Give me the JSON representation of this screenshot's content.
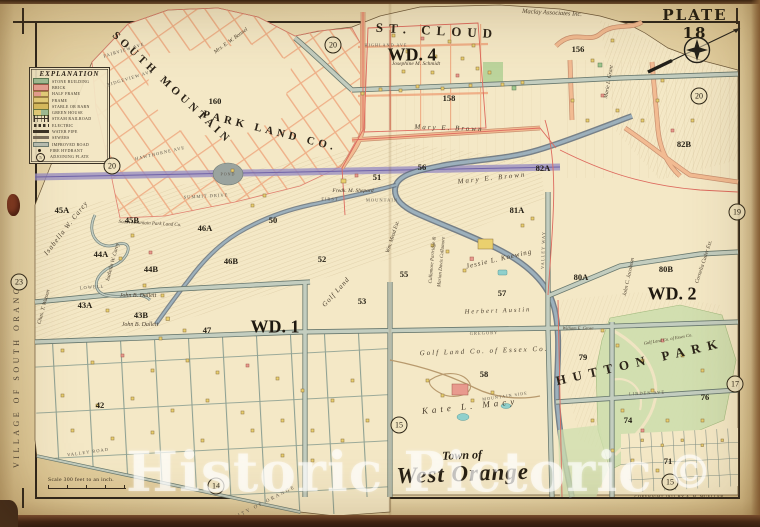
{
  "plate": {
    "label": "PLATE 18"
  },
  "title": {
    "prefix": "Town of",
    "name": "West Orange"
  },
  "village_edge": "VILLAGE OF SOUTH ORANGE",
  "scale": {
    "text": "Scale 300 feet to an inch."
  },
  "copyright": {
    "text": "COPYRIGHT 1911 BY A. H. MUELLER."
  },
  "watermark": {
    "text": "Historic Pictoric",
    "mark": "©"
  },
  "legend": {
    "title": "EXPLANATION",
    "items": [
      {
        "label": "STONE BUILDING",
        "swatch": "stone"
      },
      {
        "label": "BRICK",
        "swatch": "brick"
      },
      {
        "label": "HALF FRAME",
        "swatch": "half"
      },
      {
        "label": "FRAME",
        "swatch": "frame"
      },
      {
        "label": "STABLE OR BARN",
        "swatch": "stable"
      },
      {
        "label": "GREEN HOUSE",
        "swatch": "ghouse"
      },
      {
        "label": "STEAM RAILROAD",
        "swatch": "rail"
      },
      {
        "label": "ELECTRIC",
        "swatch": "elec"
      },
      {
        "label": "WATER PIPE",
        "swatch": "water"
      },
      {
        "label": "SEWERS",
        "swatch": "sewer"
      },
      {
        "label": "IMPROVED ROAD",
        "swatch": "road"
      },
      {
        "label": "FIRE HYDRANT",
        "swatch": "hyd"
      },
      {
        "label": "ADJOINING PLATE",
        "swatch": "plate",
        "mark": "5"
      }
    ]
  },
  "map_labels": [
    {
      "t": "ST. CLOUD",
      "x": 437,
      "y": 31,
      "r": 3,
      "s": 13,
      "ls": 6,
      "c": "region"
    },
    {
      "t": "WD. 4",
      "x": 412,
      "y": 55,
      "r": 0,
      "s": 18,
      "ls": 0,
      "c": "ward"
    },
    {
      "t": "WD. 1",
      "x": 275,
      "y": 327,
      "r": 0,
      "s": 18,
      "ls": 0,
      "c": "ward"
    },
    {
      "t": "WD. 2",
      "x": 672,
      "y": 294,
      "r": 0,
      "s": 18,
      "ls": 0,
      "c": "ward"
    },
    {
      "t": "SOUTH MOUNTAIN",
      "x": 172,
      "y": 88,
      "r": 43,
      "s": 11,
      "ls": 4,
      "c": "region"
    },
    {
      "t": "PARK LAND CO.",
      "x": 270,
      "y": 131,
      "r": 14,
      "s": 11,
      "ls": 4,
      "c": "region"
    },
    {
      "t": "HUTTON PARK",
      "x": 640,
      "y": 362,
      "r": -13,
      "s": 13,
      "ls": 7,
      "c": "region"
    },
    {
      "t": "CITY OF ORANGE",
      "x": 265,
      "y": 503,
      "r": -27,
      "s": 5,
      "ls": 2,
      "c": "street"
    },
    {
      "t": "POND",
      "x": 228,
      "y": 174,
      "r": 0,
      "s": 4,
      "ls": 1,
      "c": "street"
    },
    {
      "t": "FIRST",
      "x": 330,
      "y": 199,
      "r": 0,
      "s": 4.5,
      "ls": 1,
      "c": "street"
    },
    {
      "t": "MOUNTAIN",
      "x": 382,
      "y": 200,
      "r": 0,
      "s": 4.5,
      "ls": 1,
      "c": "street"
    },
    {
      "t": "Maclay Associates Inc.",
      "x": 552,
      "y": 13,
      "r": 3,
      "s": 6.5,
      "ls": 0,
      "c": "owner"
    },
    {
      "t": "Josephine M. Schmidt",
      "x": 416,
      "y": 64,
      "r": 0,
      "s": 5.5,
      "ls": 0,
      "c": "owner"
    },
    {
      "t": "Mary E. Brown",
      "x": 449,
      "y": 128,
      "r": 2,
      "s": 7,
      "ls": 2,
      "c": "owner"
    },
    {
      "t": "Mary E. Brown",
      "x": 492,
      "y": 178,
      "r": -6,
      "s": 7,
      "ls": 2,
      "c": "owner"
    },
    {
      "t": "Fredk. M. Shepard",
      "x": 353,
      "y": 191,
      "r": 0,
      "s": 5.5,
      "ls": 0,
      "c": "owner"
    },
    {
      "t": "Marie L. Grant",
      "x": 609,
      "y": 82,
      "r": -80,
      "s": 5.5,
      "ls": 0,
      "c": "owner"
    },
    {
      "t": "Cornelia Cutler Est.",
      "x": 704,
      "y": 262,
      "r": -72,
      "s": 5.5,
      "ls": 0,
      "c": "owner"
    },
    {
      "t": "Mrs. E. W. Bonnel",
      "x": 231,
      "y": 41,
      "r": -36,
      "s": 5.5,
      "ls": 0,
      "c": "owner"
    },
    {
      "t": "Isabella W. Carey",
      "x": 66,
      "y": 228,
      "r": -52,
      "s": 7,
      "ls": 1,
      "c": "owner"
    },
    {
      "t": "Isabella W. Carey",
      "x": 113,
      "y": 262,
      "r": -75,
      "s": 5.5,
      "ls": 0,
      "c": "owner"
    },
    {
      "t": "South Mountain Park Land Co.",
      "x": 150,
      "y": 224,
      "r": 3,
      "s": 5,
      "ls": 0,
      "c": "owner"
    },
    {
      "t": "John B. Dallett",
      "x": 138,
      "y": 296,
      "r": 0,
      "s": 6,
      "ls": 0,
      "c": "owner"
    },
    {
      "t": "John B. Dallett",
      "x": 140,
      "y": 325,
      "r": 0,
      "s": 6,
      "ls": 0,
      "c": "owner"
    },
    {
      "t": "Chas. T. Watson",
      "x": 44,
      "y": 307,
      "r": -75,
      "s": 5.5,
      "ls": 0,
      "c": "owner"
    },
    {
      "t": "Wm. Mead Est.",
      "x": 393,
      "y": 237,
      "r": -72,
      "s": 5.5,
      "ls": 0,
      "c": "owner"
    },
    {
      "t": "Cullamore Partridge &",
      "x": 433,
      "y": 260,
      "r": -85,
      "s": 5,
      "ls": 0,
      "c": "owner"
    },
    {
      "t": "Marian Davis Cullamore",
      "x": 442,
      "y": 262,
      "r": -85,
      "s": 5,
      "ls": 0,
      "c": "owner"
    },
    {
      "t": "Golf Land",
      "x": 336,
      "y": 292,
      "r": -48,
      "s": 7,
      "ls": 1,
      "c": "owner"
    },
    {
      "t": "Golf Land Co. of Essex Co.",
      "x": 484,
      "y": 351,
      "r": -2,
      "s": 7,
      "ls": 2,
      "c": "owner"
    },
    {
      "t": "Herbert Austin",
      "x": 498,
      "y": 311,
      "r": -2,
      "s": 6.5,
      "ls": 2,
      "c": "owner"
    },
    {
      "t": "Jessie L. Koewing",
      "x": 499,
      "y": 259,
      "r": -13,
      "s": 7,
      "ls": 1,
      "c": "owner"
    },
    {
      "t": "Kate L. Macy",
      "x": 470,
      "y": 406,
      "r": -6,
      "s": 9,
      "ls": 4,
      "c": "owner"
    },
    {
      "t": "John C. Jacobson",
      "x": 629,
      "y": 277,
      "r": -78,
      "s": 5.5,
      "ls": 0,
      "c": "owner"
    },
    {
      "t": "Golf Land Co. of Essex Co.",
      "x": 668,
      "y": 339,
      "r": -10,
      "s": 4.5,
      "ls": 0,
      "c": "owner"
    },
    {
      "t": "William E. Grose",
      "x": 578,
      "y": 328,
      "r": 0,
      "s": 4.5,
      "ls": 0,
      "c": "owner"
    },
    {
      "t": "FAIRVIEW AVE",
      "x": 124,
      "y": 50,
      "r": -17,
      "s": 4.5,
      "ls": 1,
      "c": "street"
    },
    {
      "t": "RIDGEVIEW AVE",
      "x": 130,
      "y": 78,
      "r": -17,
      "s": 4.5,
      "ls": 1,
      "c": "street"
    },
    {
      "t": "HAWTHORNE AVE",
      "x": 160,
      "y": 153,
      "r": -13,
      "s": 4.5,
      "ls": 1,
      "c": "street"
    },
    {
      "t": "SUMMIT DRIVE",
      "x": 206,
      "y": 196,
      "r": -3,
      "s": 4.5,
      "ls": 1,
      "c": "street"
    },
    {
      "t": "HIGHLAND AVE",
      "x": 386,
      "y": 45,
      "r": 0,
      "s": 4.2,
      "ls": 1,
      "c": "street"
    },
    {
      "t": "LOWELL",
      "x": 92,
      "y": 287,
      "r": -4,
      "s": 4.5,
      "ls": 1,
      "c": "street"
    },
    {
      "t": "GREGORY",
      "x": 484,
      "y": 333,
      "r": -2,
      "s": 4.5,
      "ls": 1,
      "c": "street"
    },
    {
      "t": "VALLEY WAY",
      "x": 543,
      "y": 250,
      "r": -88,
      "s": 4.5,
      "ls": 1,
      "c": "street"
    },
    {
      "t": "LINDEN AVE",
      "x": 647,
      "y": 393,
      "r": -3,
      "s": 4.5,
      "ls": 1,
      "c": "street"
    },
    {
      "t": "MOUNTAIN SIDE",
      "x": 505,
      "y": 396,
      "r": -8,
      "s": 4.2,
      "ls": 1,
      "c": "street"
    },
    {
      "t": "VALLEY ROAD",
      "x": 88,
      "y": 452,
      "r": -8,
      "s": 4.5,
      "ls": 1,
      "c": "street"
    }
  ],
  "block_numbers": [
    {
      "n": "160",
      "x": 215,
      "y": 101
    },
    {
      "n": "156",
      "x": 578,
      "y": 49
    },
    {
      "n": "158",
      "x": 449,
      "y": 98
    },
    {
      "n": "51",
      "x": 377,
      "y": 177
    },
    {
      "n": "50",
      "x": 273,
      "y": 220
    },
    {
      "n": "56",
      "x": 422,
      "y": 167
    },
    {
      "n": "52",
      "x": 322,
      "y": 259
    },
    {
      "n": "53",
      "x": 362,
      "y": 301
    },
    {
      "n": "55",
      "x": 404,
      "y": 274
    },
    {
      "n": "57",
      "x": 502,
      "y": 293
    },
    {
      "n": "58",
      "x": 484,
      "y": 374
    },
    {
      "n": "45A",
      "x": 62,
      "y": 210
    },
    {
      "n": "45B",
      "x": 132,
      "y": 220
    },
    {
      "n": "46A",
      "x": 205,
      "y": 228
    },
    {
      "n": "46B",
      "x": 231,
      "y": 261
    },
    {
      "n": "44A",
      "x": 101,
      "y": 254
    },
    {
      "n": "44B",
      "x": 151,
      "y": 269
    },
    {
      "n": "43A",
      "x": 85,
      "y": 305
    },
    {
      "n": "43B",
      "x": 141,
      "y": 315
    },
    {
      "n": "47",
      "x": 207,
      "y": 330
    },
    {
      "n": "42",
      "x": 100,
      "y": 405
    },
    {
      "n": "74",
      "x": 628,
      "y": 420
    },
    {
      "n": "71",
      "x": 668,
      "y": 461
    },
    {
      "n": "76",
      "x": 705,
      "y": 397
    },
    {
      "n": "79",
      "x": 583,
      "y": 357
    },
    {
      "n": "80A",
      "x": 581,
      "y": 277
    },
    {
      "n": "80B",
      "x": 666,
      "y": 269
    },
    {
      "n": "81A",
      "x": 517,
      "y": 210
    },
    {
      "n": "82A",
      "x": 543,
      "y": 168
    },
    {
      "n": "82B",
      "x": 684,
      "y": 144
    }
  ],
  "plate_circles": [
    {
      "n": "20",
      "x": 333,
      "y": 45
    },
    {
      "n": "20",
      "x": 699,
      "y": 96
    },
    {
      "n": "20",
      "x": 112,
      "y": 166
    },
    {
      "n": "23",
      "x": 19,
      "y": 282
    },
    {
      "n": "19",
      "x": 737,
      "y": 212
    },
    {
      "n": "17",
      "x": 735,
      "y": 384
    },
    {
      "n": "15",
      "x": 399,
      "y": 425
    },
    {
      "n": "14",
      "x": 216,
      "y": 486
    },
    {
      "n": "15",
      "x": 670,
      "y": 482
    }
  ]
}
